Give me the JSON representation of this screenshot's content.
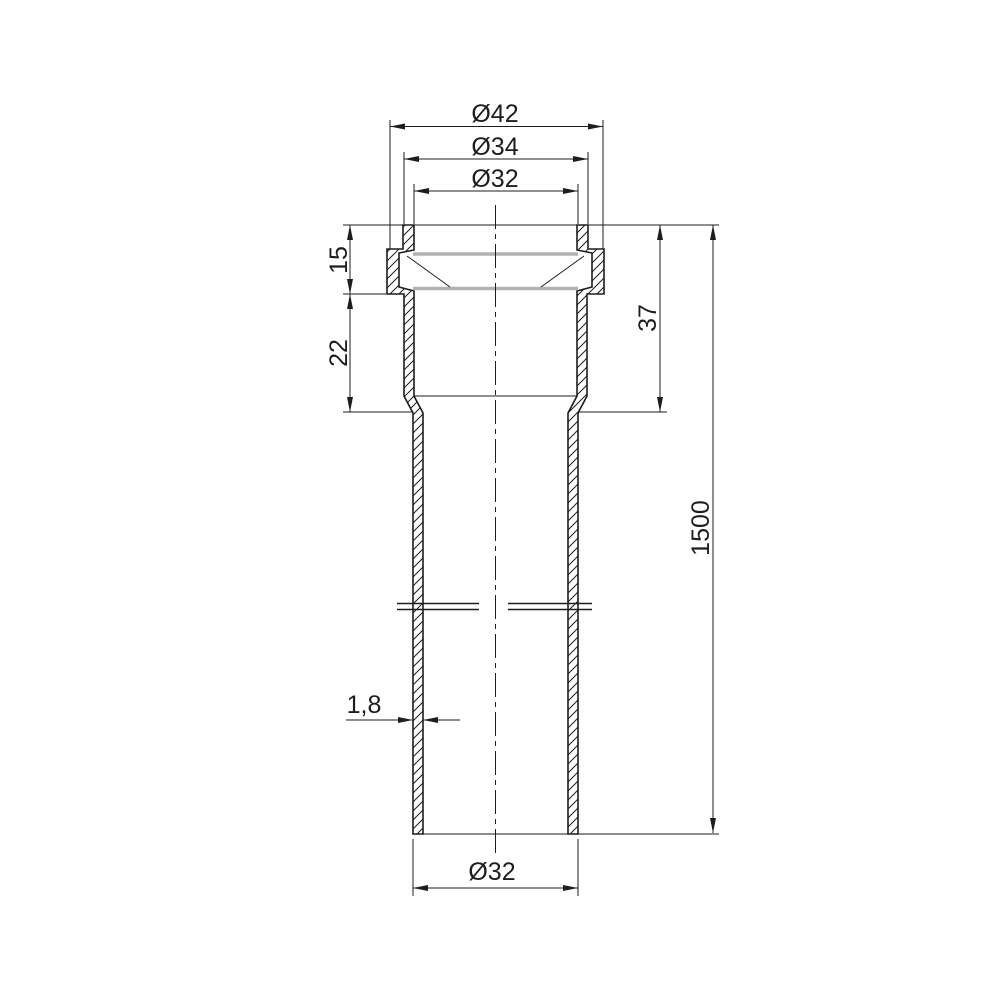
{
  "drawing": {
    "type": "technical-dimension-drawing",
    "colors": {
      "background": "#ffffff",
      "line": "#1d1d1b",
      "gasket": "#b2b2b2"
    },
    "dimensions": {
      "outer_flange_diameter": "Ø42",
      "socket_outer_diameter": "Ø34",
      "socket_inner_diameter": "Ø32",
      "rim_height": "15",
      "socket_body_height": "22",
      "socket_total_depth": "37",
      "total_length": "1500",
      "wall_thickness": "1,8",
      "pipe_outer_diameter": "Ø32"
    }
  }
}
